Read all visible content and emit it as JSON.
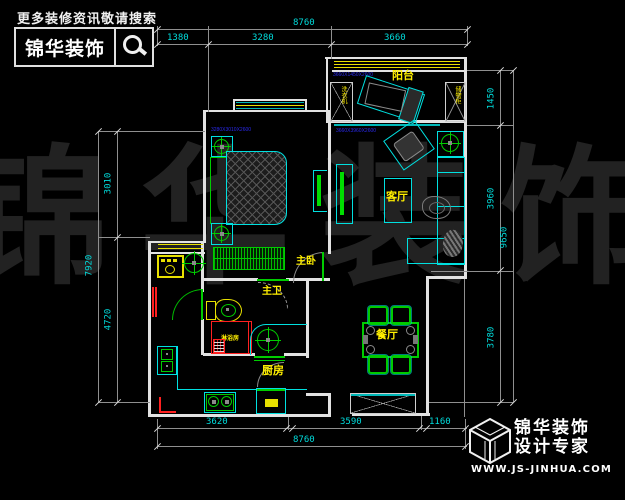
{
  "header": {
    "slogan": "更多装修资讯敬请搜索",
    "brand": "锦华装饰"
  },
  "watermark": "锦华装饰",
  "rooms": {
    "balcony": "阳台",
    "living_room": "客厅",
    "master_bedroom": "主卧",
    "master_bathroom": "主卫",
    "kitchen": "厨房",
    "dining_room": "餐厅",
    "shower_room": "淋浴房",
    "balcony_cabinet_left": "洗衣机",
    "balcony_cabinet_right": "储物柜"
  },
  "dimensions": {
    "top": {
      "total": "8760",
      "seg1": "1380",
      "seg2": "3280",
      "seg3": "3660"
    },
    "bottom": {
      "total": "8760",
      "seg1": "3620",
      "seg2": "3590",
      "seg3": "1160"
    },
    "left": {
      "total": "7920",
      "seg1": "3010",
      "seg2": "4720"
    },
    "right": {
      "total": "9650",
      "seg1": "1450",
      "seg2": "3960",
      "seg3": "3780"
    }
  },
  "annotations": {
    "bedroom": "3280X3010X2600",
    "living": "3660X3960X2600",
    "balcony": "3660X1450X2600"
  },
  "footer": {
    "brand": "锦华装饰",
    "tagline": "设计专家",
    "website": "WWW.JS-JINHUA.COM"
  },
  "colors": {
    "wall": "#e2e2e2",
    "furniture": "#00e0e0",
    "fixture": "#00cc00",
    "label": "#ffef00",
    "dimension_text": "#00dcdc",
    "annotation": "#2a2aee",
    "shower": "#ff2020",
    "watermark": "#222222"
  }
}
